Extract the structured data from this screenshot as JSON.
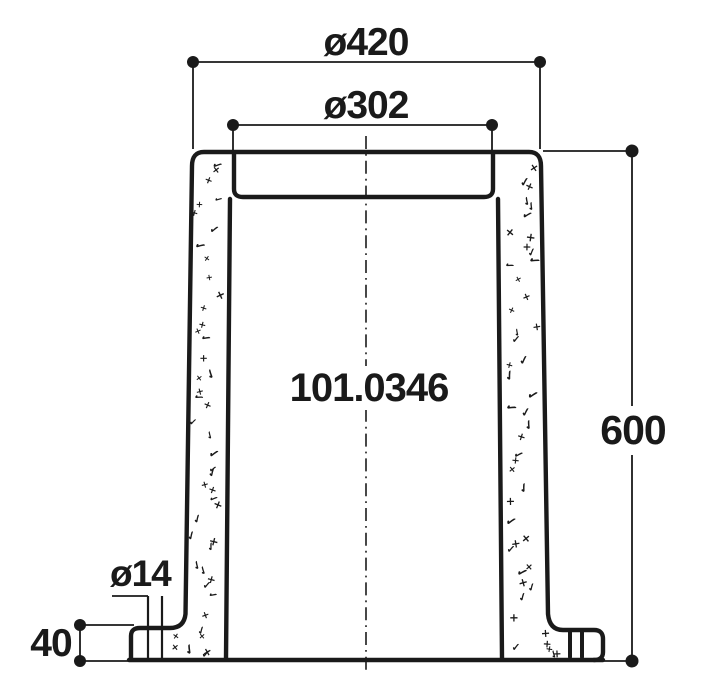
{
  "drawing": {
    "part_number": "101.0346",
    "dimensions": {
      "outer_diameter": {
        "label": "ø420"
      },
      "bore_diameter": {
        "label": "ø302"
      },
      "total_height": {
        "label": "600"
      },
      "flange_height": {
        "label": "40"
      },
      "hole_diameter": {
        "label": "ø14"
      }
    },
    "style": {
      "ink_color": "#1a1a1a",
      "background_color": "#ffffff"
    },
    "section_texture_glyphs": [
      "×",
      "✓"
    ]
  }
}
